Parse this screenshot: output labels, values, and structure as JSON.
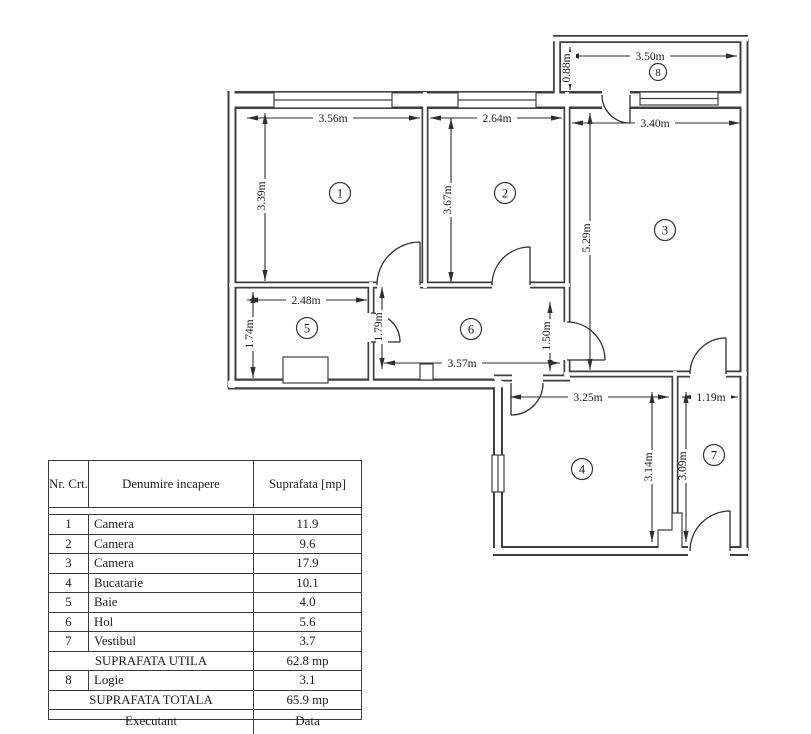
{
  "floor_plan": {
    "room_numbers": {
      "r1": "1",
      "r2": "2",
      "r3": "3",
      "r4": "4",
      "r5": "5",
      "r6": "6",
      "r7": "7",
      "r8": "8"
    },
    "dimensions": {
      "logie_width": "3.50m",
      "logie_depth": "0.88m",
      "room1_width": "3.56m",
      "room1_depth": "3.39m",
      "room2_width": "2.64m",
      "room2_depth": "3.67m",
      "room3_width": "3.40m",
      "room3_depth": "5.29m",
      "room5_width": "2.48m",
      "room5_depth": "1.74m",
      "hol_depth": "1.79m",
      "hol_width": "3.57m",
      "opening_depth": "1.50m",
      "room4_width": "3.25m",
      "room4_depth": "3.14m",
      "room7_width": "1.19m",
      "room7_depth": "3.09m"
    }
  },
  "table": {
    "headers": {
      "nr": "Nr. Crt.",
      "name": "Denumire incapere",
      "area": "Suprafata [mp]"
    },
    "rows": [
      {
        "nr": "1",
        "name": "Camera",
        "area": "11.9"
      },
      {
        "nr": "2",
        "name": "Camera",
        "area": "9.6"
      },
      {
        "nr": "3",
        "name": "Camera",
        "area": "17.9"
      },
      {
        "nr": "4",
        "name": "Bucatarie",
        "area": "10.1"
      },
      {
        "nr": "5",
        "name": "Baie",
        "area": "4.0"
      },
      {
        "nr": "6",
        "name": "Hol",
        "area": "5.6"
      },
      {
        "nr": "7",
        "name": "Vestibul",
        "area": "3.7"
      }
    ],
    "suprafata_utila": {
      "label": "SUPRAFATA UTILA",
      "value": "62.8 mp"
    },
    "logie_row": {
      "nr": "8",
      "name": "Logie",
      "area": "3.1"
    },
    "suprafata_totala": {
      "label": "SUPRAFATA TOTALA",
      "value": "65.9 mp"
    },
    "footer": {
      "executant": "Executant",
      "data": "Data"
    }
  }
}
